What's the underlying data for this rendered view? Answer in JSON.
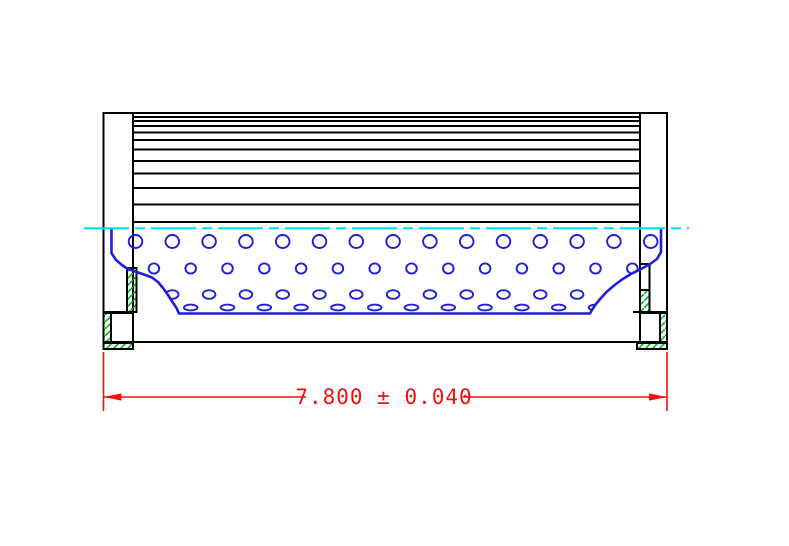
{
  "title": "Filter element cross-section drawing",
  "colors": {
    "background": "#ffffff",
    "outline": "#000000",
    "core_blue": "#1f1fd6",
    "centerline_cyan": "#00e0e6",
    "hatch_green": "#00bb22",
    "dimension_red": "#ee1111"
  },
  "dimension": {
    "label": "7.800 ± 0.040",
    "value": "7.800",
    "tolerance": "0.040",
    "line_y": 397,
    "ext_left_x": 103.5,
    "ext_right_x": 667,
    "ext_top_y": 352,
    "ext_bottom_y": 411,
    "gap_left_x": 306,
    "gap_right_x": 463,
    "text_x": 384,
    "text_y": 404,
    "arrow_len": 18,
    "arrow_half_w": 3.6
  },
  "drawing": {
    "canvas": {
      "width": 789,
      "height": 546
    },
    "pleats": {
      "x1": 133,
      "x2": 640,
      "ys": [
        113,
        117,
        121,
        126,
        132.5,
        140,
        149.5,
        161,
        173.5,
        188,
        204.5,
        222
      ]
    },
    "body_bottom": {
      "x1": 133,
      "x2": 640,
      "y": 342
    },
    "centerline": {
      "x1": 84,
      "x2": 689,
      "y": 228.3,
      "dash": "45 6 10 6"
    },
    "core_boundary": [
      [
        111.5,
        228.5
      ],
      [
        111.5,
        253
      ],
      [
        116,
        260
      ],
      [
        122,
        265
      ],
      [
        127,
        268.5
      ],
      [
        135,
        271.5
      ],
      [
        144,
        274.5
      ],
      [
        152,
        277.5
      ],
      [
        158,
        282
      ],
      [
        163,
        288
      ],
      [
        168,
        295
      ],
      [
        172.5,
        302
      ],
      [
        176.5,
        308
      ],
      [
        179,
        313.5
      ],
      [
        590,
        313.5
      ],
      [
        592.5,
        309
      ],
      [
        596,
        304
      ],
      [
        601,
        298
      ],
      [
        607,
        291.5
      ],
      [
        614,
        285.5
      ],
      [
        622,
        279.5
      ],
      [
        631,
        274
      ],
      [
        641,
        269
      ],
      [
        650,
        264
      ],
      [
        657,
        259
      ],
      [
        661,
        252
      ],
      [
        661,
        228.5
      ]
    ],
    "perforation_rows": [
      {
        "y": 241.5,
        "rx": 6.8,
        "ry": 6.5,
        "xs": [
          135.5,
          172.3,
          209.1,
          245.9,
          282.7,
          319.5,
          356.3,
          393.1,
          429.9,
          466.7,
          503.5,
          540.3,
          577.1,
          613.9,
          650.7
        ]
      },
      {
        "y": 268.5,
        "rx": 5.3,
        "ry": 5.1,
        "xs": [
          153.9,
          190.7,
          227.5,
          264.3,
          301.1,
          337.9,
          374.7,
          411.5,
          448.3,
          485.1,
          521.9,
          558.7,
          595.5,
          632.3
        ]
      },
      {
        "y": 294.5,
        "rx": 6.3,
        "ry": 4.3,
        "xs": [
          172.3,
          209.1,
          245.9,
          282.7,
          319.5,
          356.3,
          393.1,
          429.9,
          466.7,
          503.5,
          540.3,
          577.1,
          613.9
        ]
      },
      {
        "y": 307.5,
        "rx": 6.8,
        "ry": 2.9,
        "xs": [
          153.9,
          190.7,
          227.5,
          264.3,
          301.1,
          337.9,
          374.7,
          411.5,
          448.3,
          485.1,
          521.9,
          558.7,
          595.5
        ]
      }
    ]
  }
}
